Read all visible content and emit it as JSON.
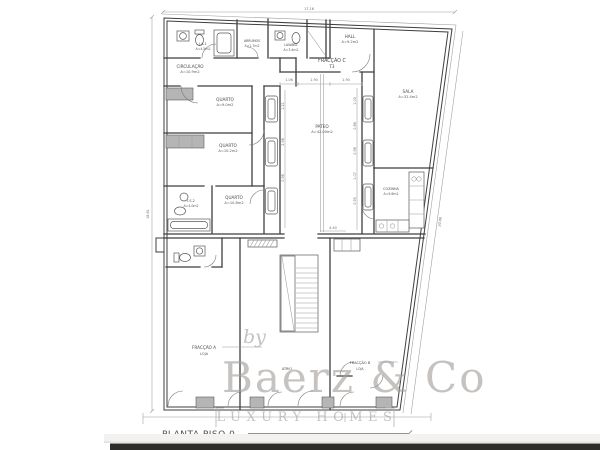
{
  "plan": {
    "title": "PLANTA PISO 0",
    "fraction_c": {
      "name": "FRACÇÃO C",
      "type": "T3"
    },
    "fraction_a": {
      "name": "FRACÇÃO A",
      "type": "LOJA"
    },
    "fraction_b": {
      "name": "FRACÇÃO B",
      "type": "LOJA"
    },
    "rooms": {
      "is1": {
        "name": "I.S.1",
        "area": "A=4.5m2"
      },
      "arrumos": {
        "name": "ARRUMOS",
        "area": "A=1.7m2"
      },
      "lavand": {
        "name": "LAVAND.",
        "area": "A=3.4m2"
      },
      "hall": {
        "name": "HALL",
        "area": "A=9.2m2"
      },
      "circulacao": {
        "name": "CIRCULAÇÃO",
        "area": "A=10.9m2"
      },
      "quarto1": {
        "name": "QUARTO",
        "area": "A=9.0m2"
      },
      "quarto2": {
        "name": "QUARTO",
        "area": "A=10.2m2"
      },
      "is2": {
        "name": "I.S.2",
        "area": "A=4.0m2"
      },
      "quarto3": {
        "name": "QUARTO",
        "area": "A=10.8m2"
      },
      "pateo": {
        "name": "PATEO",
        "area": "A=42.00m2"
      },
      "sala": {
        "name": "SALA",
        "area": "A=32.4m2"
      },
      "cozinha": {
        "name": "COZINHA",
        "area": "A=9.8m2"
      },
      "atrio": {
        "name": "ATRIO"
      }
    }
  },
  "dimensions": {
    "top_width": "17.16",
    "left_height": "18.61",
    "right_height": "20.00",
    "atrio_width": "4.40",
    "pateo_top": [
      "1.06",
      "1.90",
      "1.90"
    ],
    "pateo_left": [
      "1.21",
      "2.98",
      "0.98"
    ],
    "pateo_right": [
      "1.03",
      "0.86",
      "0.98",
      "1.07",
      "0.95"
    ]
  },
  "watermark": {
    "by": "by",
    "brand": "Baerz & Co",
    "tagline": "LUXURY HOMES"
  },
  "colors": {
    "wall": "#3f3f3f",
    "thin_line": "#9a9a9a",
    "label_text": "#4a4a4a",
    "watermark": "#a29e9a",
    "photo_band_dark": "#2e2c2b",
    "photo_band_light": "#f3f2f0",
    "background": "#ffffff"
  }
}
